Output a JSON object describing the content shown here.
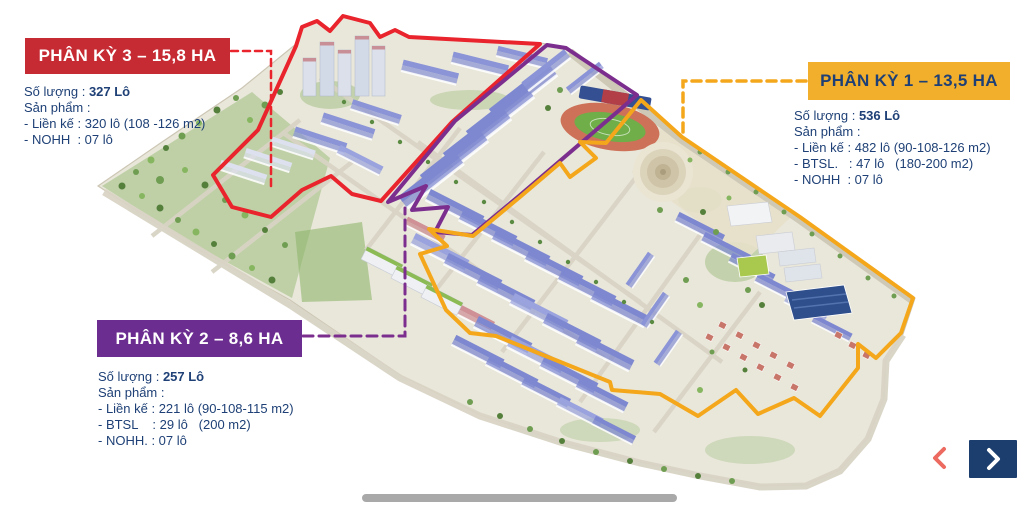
{
  "page": {
    "background": "#FFFFFF",
    "text_color": "#1E4076"
  },
  "cards": {
    "phase3": {
      "title": "PHÂN KỲ 3 – 15,8 HA",
      "box_color": "#C62A32",
      "quantity_label": "Số lượng :",
      "quantity_value": "327 Lô",
      "products_label": "Sản phẩm :",
      "products": [
        "- Liền kế : 320 lô (108 -126 m2)",
        "- NOHH  : 07 lô"
      ]
    },
    "phase1": {
      "title": "PHÂN KỲ 1 – 13,5 HA",
      "box_color": "#F2AF2B",
      "quantity_label": "Số lượng :",
      "quantity_value": "536 Lô",
      "products_label": "Sản phẩm :",
      "products": [
        "- Liền kế : 482 lô (90-108-126 m2)",
        "- BTSL.   : 47 lô   (180-200 m2)",
        "- NOHH  : 07 lô"
      ]
    },
    "phase2": {
      "title": "PHÂN KỲ 2 – 8,6 HA",
      "box_color": "#6C2D90",
      "quantity_label": "Số lượng :",
      "quantity_value": "257 Lô",
      "products_label": "Sản phẩm :",
      "products": [
        "- Liền kế : 221 lô (90-108-115 m2)",
        "- BTSL    : 29 lô   (200 m2)",
        "- NOHH. : 07 lô"
      ]
    }
  },
  "map": {
    "zone_outline_colors": {
      "phase1": "#F4A71B",
      "phase2": "#7C2E8E",
      "phase3": "#E9242C"
    },
    "features": [
      "high-rise-towers",
      "townhouse-rows",
      "stadium",
      "central-plaza",
      "sports-hall",
      "villas",
      "apartments",
      "parks"
    ]
  },
  "nav": {
    "prev_icon": "chevron-left",
    "prev_color": "#EC6A5F",
    "next_icon": "chevron-right",
    "next_bg": "#1C3E6E",
    "next_color": "#FFFFFF"
  },
  "slider": {
    "color": "#A9A9A9"
  }
}
